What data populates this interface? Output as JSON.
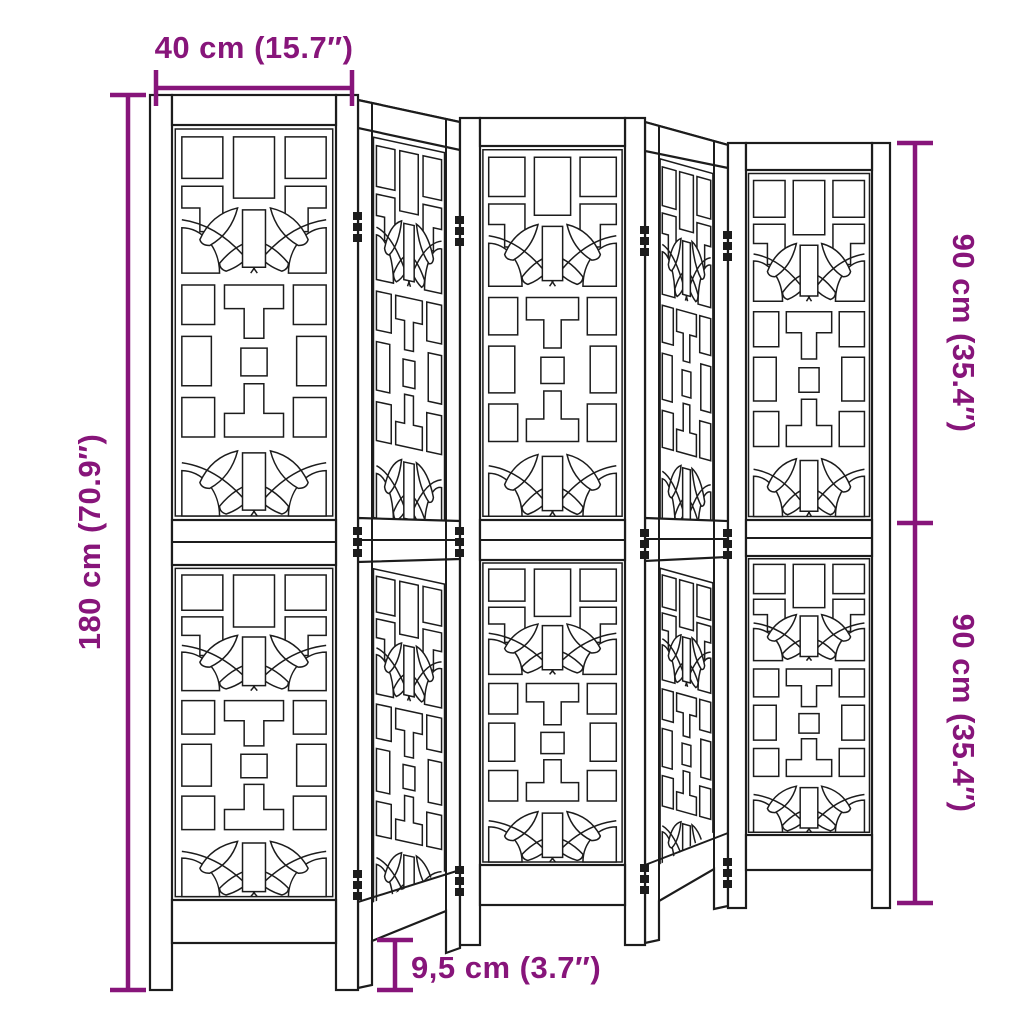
{
  "diagram": {
    "product_name": "Room divider with 5 ornamental cut-out panels",
    "panel_count": 5,
    "background_color": "#ffffff",
    "line_color": "#1c1c1c",
    "dimension_color": "#87157A"
  },
  "dimensions": {
    "panel_width": {
      "label": "40 cm (15.7″)"
    },
    "total_height": {
      "label": "180 cm (70.9″)"
    },
    "upper_section_height": {
      "label": "90 cm (35.4″)"
    },
    "lower_section_height": {
      "label": "90 cm (35.4″)"
    },
    "leg_height": {
      "label": "9,5 cm (3.7″)"
    }
  }
}
